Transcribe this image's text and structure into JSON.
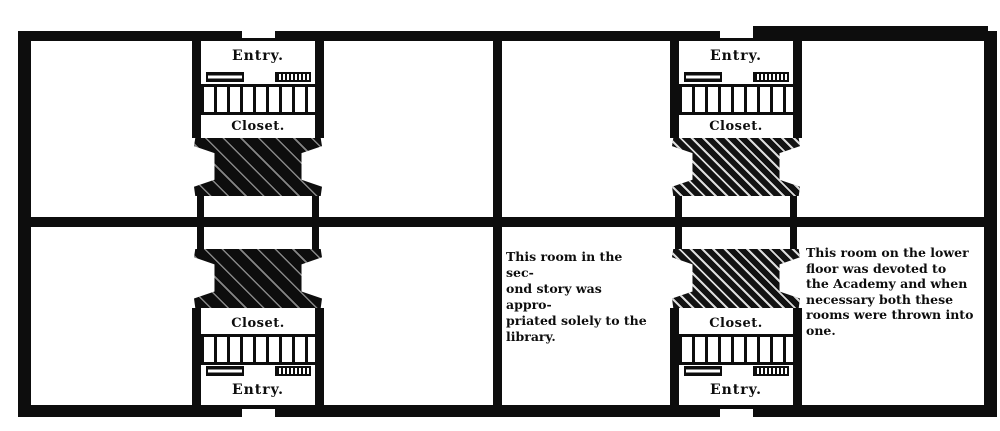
{
  "figure": {
    "type": "scanned floor plan, two stories of an academy building",
    "ink_color": "#0d0d0d",
    "paper_color": "#ffffff"
  },
  "plans": [
    {
      "side": "left",
      "upper": {
        "entry": "Entry.",
        "closet": "Closet."
      },
      "lower": {
        "closet": "Closet.",
        "entry": "Entry."
      }
    },
    {
      "side": "right",
      "upper": {
        "entry": "Entry.",
        "closet": "Closet."
      },
      "lower": {
        "closet": "Closet.",
        "entry": "Entry."
      }
    }
  ],
  "annotations": [
    {
      "id": "library-note",
      "text": "This room in the sec-\nond story was appro-\npriated solely to the\nlibrary."
    },
    {
      "id": "academy-note",
      "text": "This room on the lower\nfloor was devoted to\nthe Academy and when\nnecessary both these\nrooms were thrown into\none."
    }
  ]
}
